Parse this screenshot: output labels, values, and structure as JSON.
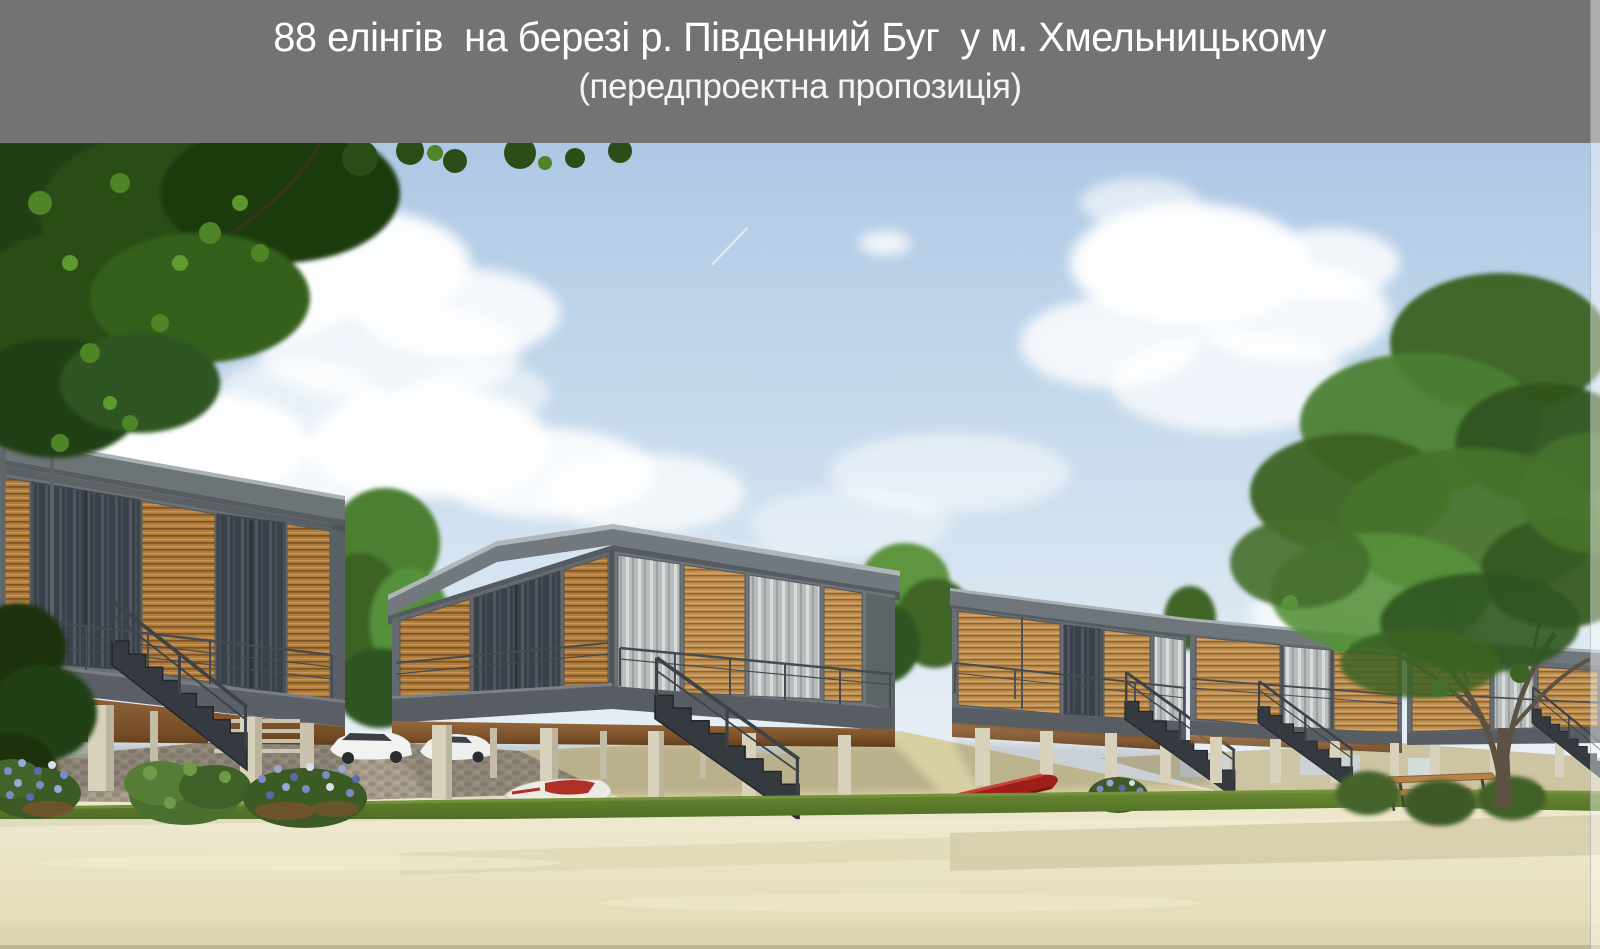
{
  "header": {
    "title": "88 елінгів  на березі р. Південний Буг  у м. Хмельницькому",
    "subtitle": "(передпроектна пропозиція)",
    "colors": {
      "background": "#747272",
      "text": "#ffffff"
    }
  },
  "scene": {
    "kind": "architectural-3d-rendering",
    "objects": {
      "cabins": "row of flat-roofed boathouses on concrete stilts with timber-slat facades, glass doors, balcony railings and steel stairs",
      "vehicles": [
        "white car",
        "white car"
      ],
      "boats": [
        "white jet ski with red seat",
        "red kayak"
      ],
      "furniture": [
        "wooden picnic table with benches"
      ],
      "vegetation": [
        "overhanging tree canopy top-left",
        "large tree on the right",
        "small trees between cabins",
        "blue flower bushes",
        "green shrubs"
      ],
      "ground": [
        "cobblestone pavement under cabins",
        "sand ramps",
        "grass strip",
        "sandy beach foreground"
      ],
      "sky": [
        "light blue sky",
        "white cumulus clouds",
        "faint jet contrail"
      ]
    },
    "palette": {
      "sky_top": "#aec8e4",
      "sky_horizon": "#eef3f6",
      "cloud": "#ffffff",
      "concrete_frame": "#6b7176",
      "timber_slats": "#b07c3c",
      "window_glass": "#39414a",
      "curtain_glass": "#b7bcbd",
      "deck_underside": "#8a5a30",
      "pillar": "#d8d2bd",
      "stair_steel": "#343a3f",
      "foliage_dark": "#233f12",
      "foliage_light": "#57913a",
      "grass": "#5d7d33",
      "sand": "#eae5c6",
      "pavement": "#a89e8e",
      "kayak_red": "#9e1f1a",
      "flowers_blue": "#7b8cc4"
    }
  }
}
